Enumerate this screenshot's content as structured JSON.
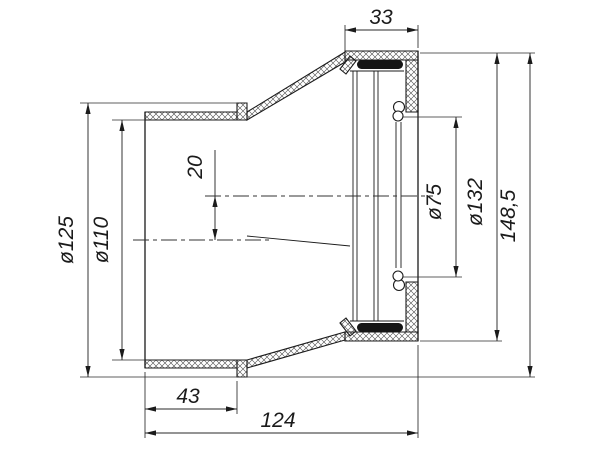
{
  "drawing": {
    "dimensions": {
      "socket_depth": "33",
      "flange_diameter": "ø125",
      "spigot_diameter": "ø110",
      "axis_offset": "20",
      "outlet_diameter": "ø75",
      "socket_outer_diameter": "ø132",
      "overall_height": "148,5",
      "spigot_length": "43",
      "overall_length": "124"
    },
    "colors": {
      "line": "#1b1b1b",
      "seal": "#151515",
      "background": "#ffffff"
    }
  }
}
